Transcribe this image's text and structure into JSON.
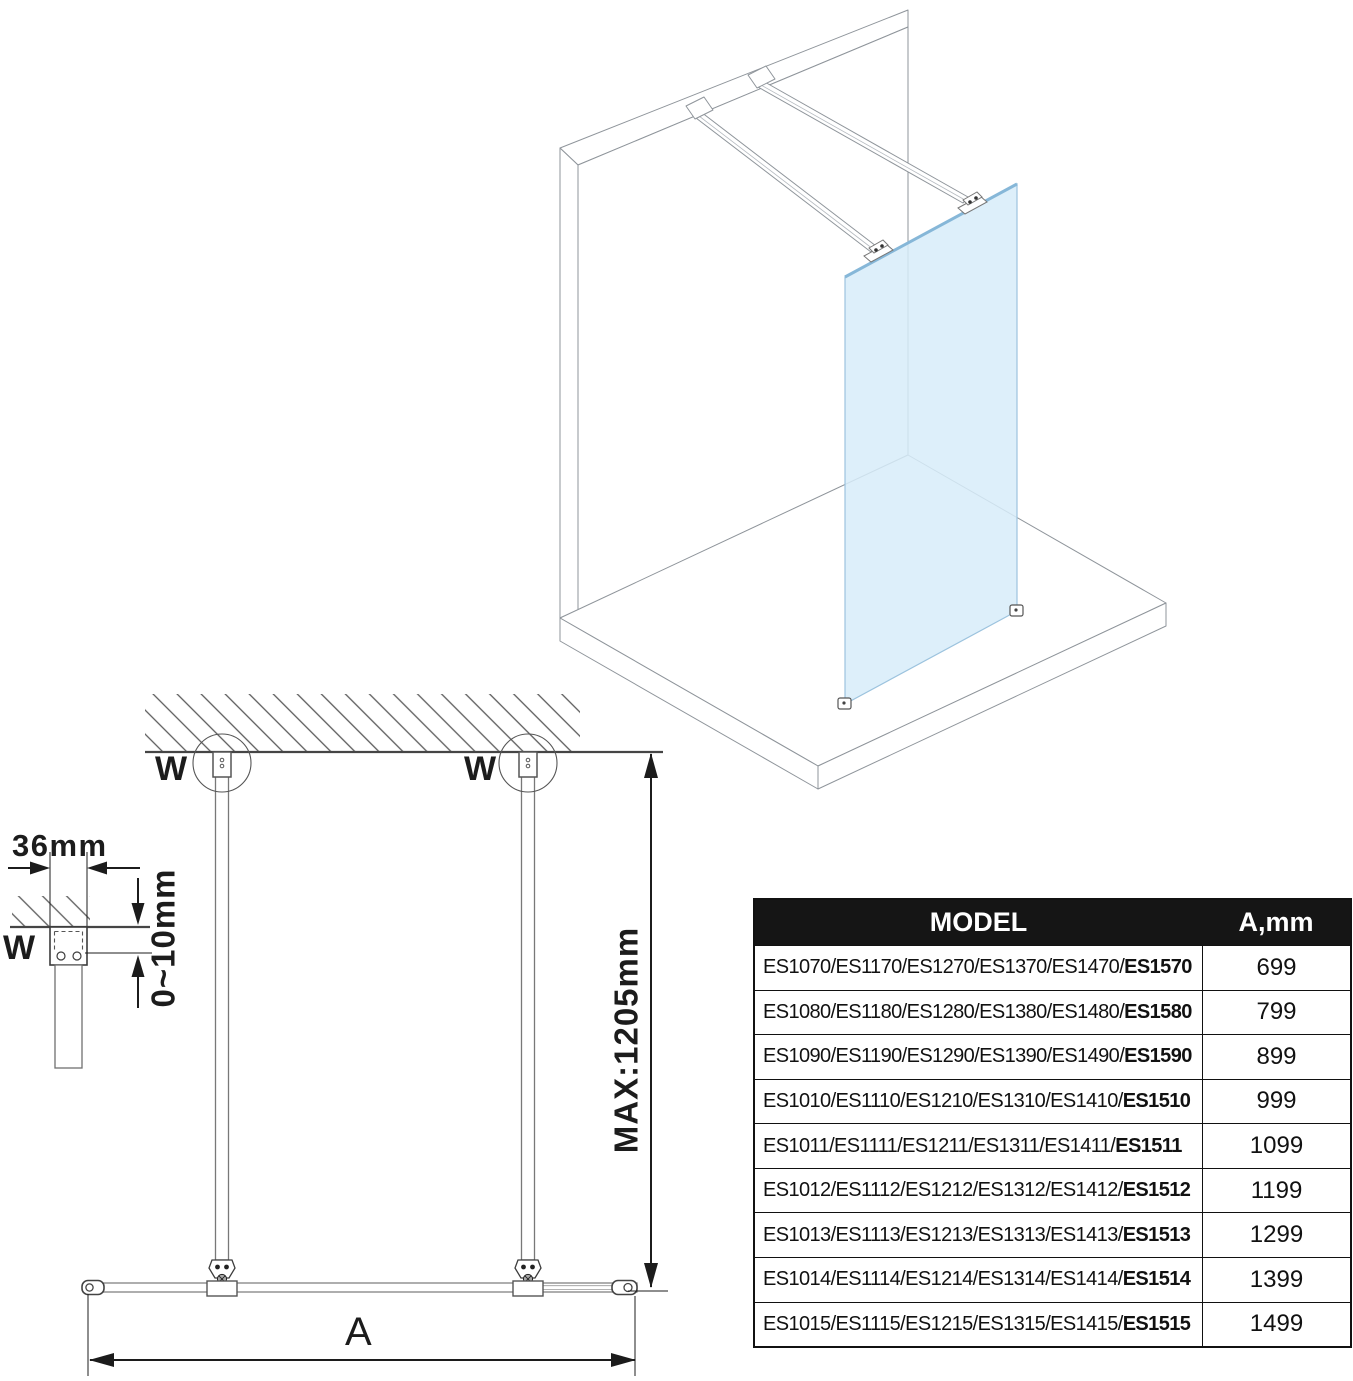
{
  "diagram": {
    "wall_anchor_label": "W",
    "dimensions": {
      "bracket_width": "36mm",
      "wall_gap": "0~10mm",
      "max_length": "MAX:1205mm",
      "glass_width": "A"
    },
    "colors": {
      "glass": "#d7ecf9",
      "glass_edge": "#9cc3de",
      "outline": "#8f959b",
      "dimension": "#1c1c1c",
      "table_header_bg": "#151515"
    }
  },
  "table": {
    "header": {
      "model": "MODEL",
      "dimension": "A,mm"
    },
    "rows": [
      {
        "models": "ES1070/ES1170/ES1270/ES1370/ES1470/",
        "models_bold": "ES1570",
        "a_mm": "699"
      },
      {
        "models": "ES1080/ES1180/ES1280/ES1380/ES1480/",
        "models_bold": "ES1580",
        "a_mm": "799"
      },
      {
        "models": "ES1090/ES1190/ES1290/ES1390/ES1490/",
        "models_bold": "ES1590",
        "a_mm": "899"
      },
      {
        "models": "ES1010/ES1110/ES1210/ES1310/ES1410/",
        "models_bold": "ES1510",
        "a_mm": "999"
      },
      {
        "models": "ES1011/ES1111/ES1211/ES1311/ES1411/",
        "models_bold": "ES1511",
        "a_mm": "1099"
      },
      {
        "models": "ES1012/ES1112/ES1212/ES1312/ES1412/",
        "models_bold": "ES1512",
        "a_mm": "1199"
      },
      {
        "models": "ES1013/ES1113/ES1213/ES1313/ES1413/",
        "models_bold": "ES1513",
        "a_mm": "1299"
      },
      {
        "models": "ES1014/ES1114/ES1214/ES1314/ES1414/",
        "models_bold": "ES1514",
        "a_mm": "1399"
      },
      {
        "models": "ES1015/ES1115/ES1215/ES1315/ES1415/",
        "models_bold": "ES1515",
        "a_mm": "1499"
      }
    ]
  }
}
